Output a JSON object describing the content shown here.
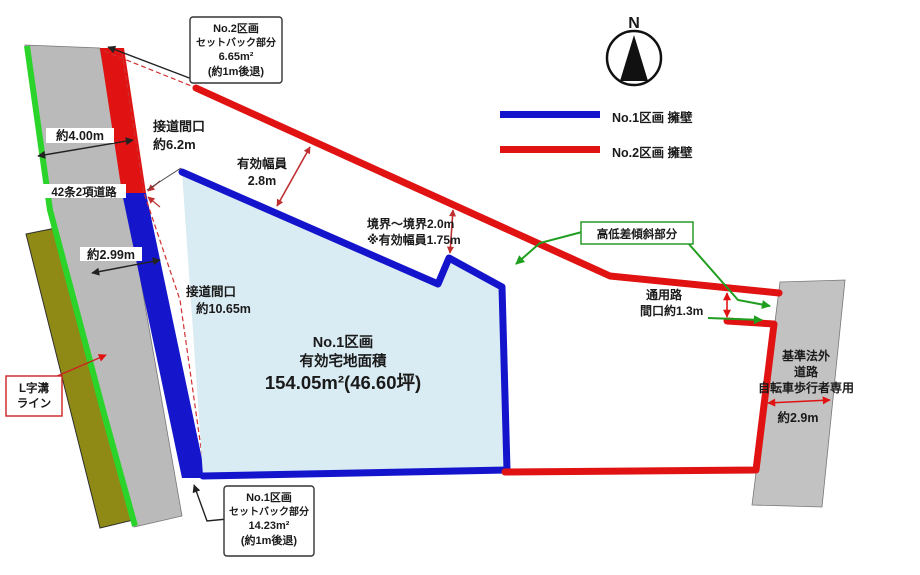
{
  "colors": {
    "no1_blue": "#1414cc",
    "no2_red": "#e01212",
    "green_line": "#2bd42b",
    "olive": "#8e8a15",
    "road_gray": "#bababa",
    "parcel_fill": "#d9ebf3",
    "leader_green": "#1f9e1f"
  },
  "compass": {
    "north": "N"
  },
  "legend": {
    "no1": "No.1区画 擁壁",
    "no2": "No.2区画 擁壁"
  },
  "callout_no2_setback": {
    "l1": "No.2区画",
    "l2": "セットバック部分",
    "l3": "6.65m²",
    "l4": "(約1m後退)"
  },
  "callout_no1_setback": {
    "l1": "No.1区画",
    "l2": "セットバック部分",
    "l3": "14.23m²",
    "l4": "(約1m後退)"
  },
  "callout_l_gutter": {
    "l1": "L字溝",
    "l2": "ライン"
  },
  "callout_slope": {
    "label": "高低差傾斜部分"
  },
  "left_road": {
    "width": "約4.00m",
    "type": "42条2項道路"
  },
  "frontage_no2": {
    "l1": "接道間口",
    "l2": "約6.2m"
  },
  "effective_width": {
    "l1": "有効幅員",
    "l2": "2.8m"
  },
  "boundary_note": {
    "l1": "境界～境界2.0m",
    "l2": "※有効幅員1.75m"
  },
  "side_width": "約2.99m",
  "frontage_no1": {
    "l1": "接道間口",
    "l2": "約10.65m"
  },
  "passage": {
    "l1": "通用路",
    "l2": "間口約1.3m"
  },
  "parcel_no1": {
    "l1": "No.1区画",
    "l2": "有効宅地面積",
    "l3": "154.05m²(46.60坪)"
  },
  "rear_road": {
    "l1": "基準法外",
    "l2": "道路",
    "l3": "自転車歩行者専用",
    "width": "約2.9m"
  }
}
